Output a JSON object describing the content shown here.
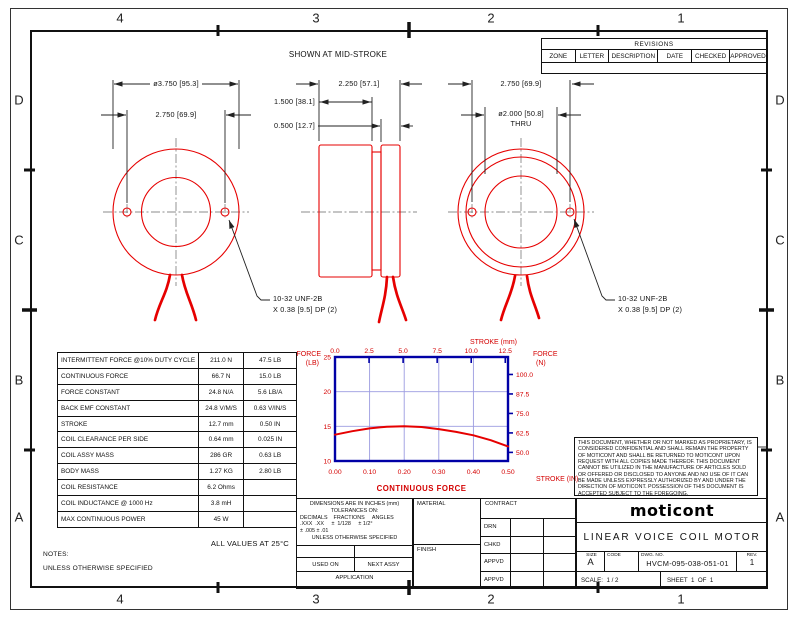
{
  "sheet": {
    "zones_horizontal": [
      "4",
      "3",
      "2",
      "1"
    ],
    "zones_vertical": [
      "D",
      "C",
      "B",
      "A"
    ]
  },
  "revisions": {
    "title": "REVISIONS",
    "columns": [
      "ZONE",
      "LETTER",
      "DESCRIPTION",
      "DATE",
      "CHECKED",
      "APPROVED"
    ]
  },
  "drawing": {
    "caption": "SHOWN AT MID-STROKE",
    "dims": {
      "front_od": "ø3.750 [95.3]",
      "front_bolt_circle": "2.750 [69.9]",
      "side_overall": "2.250 [57.1]",
      "side_body": "1.500 [38.1]",
      "side_plate": "0.500 [12.7]",
      "rear_bolt_circle": "2.750 [69.9]",
      "rear_bore": "ø2.000 [50.8]",
      "rear_bore_note": "THRU"
    },
    "tap_note_left_1": "10-32 UNF-2B",
    "tap_note_left_2": "X 0.38 [9.5] DP (2)",
    "tap_note_right_1": "10-32 UNF-2B",
    "tap_note_right_2": "X 0.38 [9.5] DP (2)"
  },
  "spec_table": {
    "rows": [
      {
        "label": "INTERMITTENT FORCE @10% DUTY CYCLE",
        "metric": "211.0 N",
        "imperial": "47.5 LB"
      },
      {
        "label": "CONTINUOUS FORCE",
        "metric": "66.7 N",
        "imperial": "15.0 LB"
      },
      {
        "label": "FORCE CONSTANT",
        "metric": "24.8 N/A",
        "imperial": "5.6 LB/A"
      },
      {
        "label": "BACK EMF CONSTANT",
        "metric": "24.8 V/M/S",
        "imperial": "0.63 V/IN/S"
      },
      {
        "label": "STROKE",
        "metric": "12.7 mm",
        "imperial": "0.50 IN"
      },
      {
        "label": "COIL CLEARANCE PER SIDE",
        "metric": "0.64 mm",
        "imperial": "0.025 IN"
      },
      {
        "label": "COIL ASSY MASS",
        "metric": "286 GR",
        "imperial": "0.63 LB"
      },
      {
        "label": "BODY MASS",
        "metric": "1.27 KG",
        "imperial": "2.80 LB"
      },
      {
        "label": "COIL RESISTANCE",
        "metric": "6.2 Ohms",
        "imperial": ""
      },
      {
        "label": "COIL INDUCTANCE @ 1000 Hz",
        "metric": "3.8 mH",
        "imperial": ""
      },
      {
        "label": "MAX CONTINUOUS POWER",
        "metric": "45 W",
        "imperial": ""
      }
    ]
  },
  "notes": {
    "all_values": "ALL VALUES AT 25°C",
    "notes_label": "NOTES:",
    "unless": "UNLESS OTHERWISE SPECIFIED"
  },
  "chart_data": {
    "type": "line",
    "title": "CONTINUOUS FORCE",
    "axes": {
      "top": {
        "label": "STROKE (mm)",
        "ticks": [
          "0.0",
          "2.5",
          "5.0",
          "7.5",
          "10.0",
          "12.5"
        ],
        "max_mm": 12.7
      },
      "bottom": {
        "label": "STROKE (IN)",
        "ticks": [
          "0.00",
          "0.10",
          "0.20",
          "0.30",
          "0.40",
          "0.50"
        ],
        "max_in": 0.5
      },
      "left": {
        "label": "FORCE (LB)",
        "ticks": [
          "25",
          "20",
          "15",
          "10"
        ],
        "range_lb": [
          25,
          10
        ]
      },
      "right": {
        "label": "FORCE (N)",
        "ticks": [
          "100.0",
          "87.5",
          "75.0",
          "62.5",
          "50.0"
        ],
        "range_n": [
          111.2,
          44.5
        ]
      }
    },
    "grid": {
      "vertical_at_in": [
        0.1,
        0.2,
        0.3,
        0.4
      ],
      "horizontal_at_lb": [
        20,
        15
      ]
    },
    "series": [
      {
        "name": "CONTINUOUS FORCE",
        "stroke_in": [
          0,
          0.05,
          0.1,
          0.15,
          0.2,
          0.25,
          0.3,
          0.35,
          0.4,
          0.45,
          0.5
        ],
        "force_lb": [
          13.8,
          14.3,
          14.7,
          14.95,
          15.0,
          14.9,
          14.6,
          14.2,
          13.7,
          13.0,
          12.1
        ]
      }
    ]
  },
  "proprietary_note": "THIS DOCUMENT, WHETHER OR NOT MARKED AS PROPRIETARY, IS CONSIDERED CONFIDENTIAL AND SHALL REMAIN THE PROPERTY OF MOTICONT AND SHALL BE RETURNED TO MOTICONT UPON REQUEST WITH ALL COPIES MADE THEREOF. THIS DOCUMENT CANNOT BE UTILIZED IN THE MANUFACTURE OF ARTICLES SOLD OR OFFERED OR DISCLOSED TO ANYONE AND NO USE OF IT CAN BE MADE UNLESS EXPRESSLY AUTHORIZED BY AND UNDER THE DIRECTION OF MOTICONT. POSSESSION OF THIS DOCUMENT IS ACCEPTED SUBJECT TO THE FOREGOING.",
  "tolerance_block": {
    "line1": "DIMENSIONS ARE IN INCHES (mm)",
    "line2": "TOLERANCES ON:",
    "line3": "DECIMALS    FRACTIONS     ANGLES",
    "line4": ".XXX  .XX     ±  1/128     ± 1/2°",
    "line5": "± .005 ± .01",
    "line6": "UNLESS OTHERWISE SPECIFIED",
    "used_on": "USED ON",
    "next_assy": "NEXT ASSY",
    "application": "APPLICATION"
  },
  "approval_block": {
    "material": "MATERIAL",
    "finish": "FINISH",
    "contract": "CONTRACT",
    "rows": [
      "DRN",
      "CHKD",
      "APPVD",
      "APPVD"
    ]
  },
  "title_block": {
    "logo": "moticont",
    "title": "LINEAR VOICE COIL MOTOR",
    "size_label": "SIZE",
    "size": "A",
    "code_label": "CODE",
    "dwg_label": "DWG. NO.",
    "dwg_no": "HVCM-095-038-051-01",
    "rev_label": "REV.",
    "rev": "1",
    "scale_label": "SCALE:  1 / 2",
    "sheet_label": "SHEET  1  OF  1"
  }
}
